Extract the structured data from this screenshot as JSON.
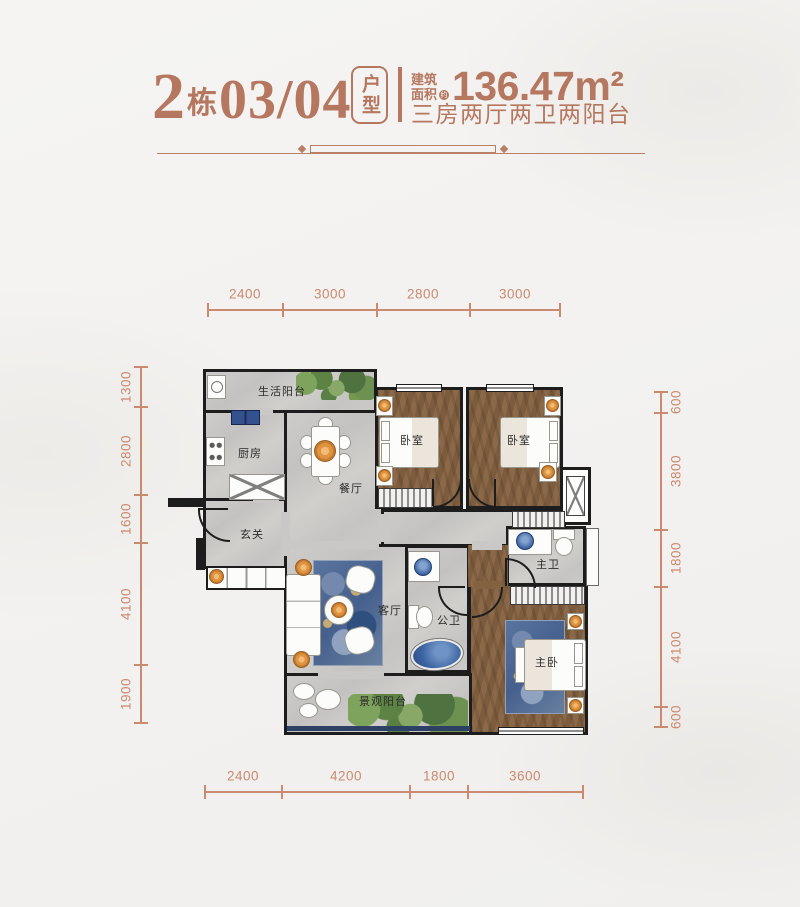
{
  "header": {
    "building_number": "2",
    "building_unit": "栋",
    "unit_numbers": "03/04",
    "type_badge": "户型",
    "area_label": "建筑面积",
    "area_approx_mark": "约",
    "area_value": "136.47m²",
    "layout_summary": "三房两厅两卫两阳台"
  },
  "rooms": {
    "life_balcony": "生活阳台",
    "kitchen": "厨房",
    "dining_room": "餐厅",
    "bedroom_left": "卧室",
    "bedroom_right": "卧室",
    "foyer": "玄关",
    "living_room": "客厅",
    "public_bathroom": "公卫",
    "master_bathroom": "主卫",
    "master_bedroom": "主卧",
    "view_balcony": "景观阳台"
  },
  "dimensions": {
    "top": [
      "2400",
      "3000",
      "2800",
      "3000"
    ],
    "bottom": [
      "2400",
      "4200",
      "1800",
      "3600"
    ],
    "left": [
      "1300",
      "2800",
      "1600",
      "4100",
      "1900"
    ],
    "right": [
      "600",
      "3800",
      "1800",
      "4100",
      "600"
    ]
  },
  "colors": {
    "accent": "#b5775f",
    "dimension": "#ca8a70",
    "wall": "#1d1d1d",
    "wood_floor": "#84613f",
    "tile_floor": "#c9c8c6",
    "water_blue": "#3c63a2",
    "plant_green": "#6d8d4f",
    "decor_orange": "#e09a4d"
  }
}
